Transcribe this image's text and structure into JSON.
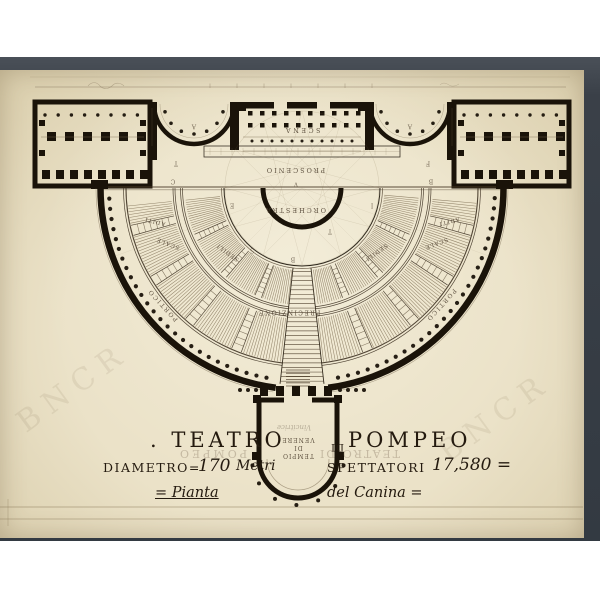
{
  "colors": {
    "scan_background": "#ffffff",
    "photo_border": "#3a4048",
    "paper": "#e9e0c6",
    "ink": "#1a1309",
    "fine_line": "#7b6b50"
  },
  "plan_labels": {
    "scena": "SCENA",
    "proscenio": "PROSCENIO",
    "orchestra": "ORCHESTRA",
    "precinzione": "PRECINZIONE",
    "portico_left": "PORTICO",
    "portico_right": "PORTICO",
    "aditi_left": "ADITI",
    "aditi_right": "ADITI",
    "scale_left": "SCALE",
    "scale_right": "SCALE",
    "sedili_left": "SEDILI",
    "sedili_right": "SEDILI",
    "temple": {
      "line1": "TEMPIO",
      "line2": "DI",
      "line3": "VENERE",
      "ghost": "Vincitrice"
    }
  },
  "reference_letters": [
    {
      "ch": "V",
      "x": 296,
      "y": 184
    },
    {
      "ch": "A",
      "x": 194,
      "y": 126
    },
    {
      "ch": "A",
      "x": 410,
      "y": 126
    },
    {
      "ch": "T",
      "x": 176,
      "y": 163
    },
    {
      "ch": "F",
      "x": 428,
      "y": 163
    },
    {
      "ch": "C",
      "x": 173,
      "y": 181
    },
    {
      "ch": "B",
      "x": 431,
      "y": 181
    },
    {
      "ch": "S",
      "x": 252,
      "y": 250
    },
    {
      "ch": "B",
      "x": 293,
      "y": 259
    },
    {
      "ch": "T",
      "x": 330,
      "y": 231
    },
    {
      "ch": "E",
      "x": 232,
      "y": 205
    },
    {
      "ch": "I",
      "x": 372,
      "y": 205
    }
  ],
  "title_block": {
    "teatro": ". TEATRO",
    "di": "DI",
    "pompeo": "POMPEO",
    "ghost_pompeo": "POMPEO",
    "ghost_teatro_di": "TEATRO DI",
    "diametro_label": "DIAMETRO=",
    "diametro_value": "170",
    "diametro_unit": "Metri",
    "spettatori_label": "SPETTATORI",
    "spettatori_value": "17,580 =",
    "pianta": "= Pianta",
    "canina": "del Canina ="
  },
  "watermark": "BNCR"
}
